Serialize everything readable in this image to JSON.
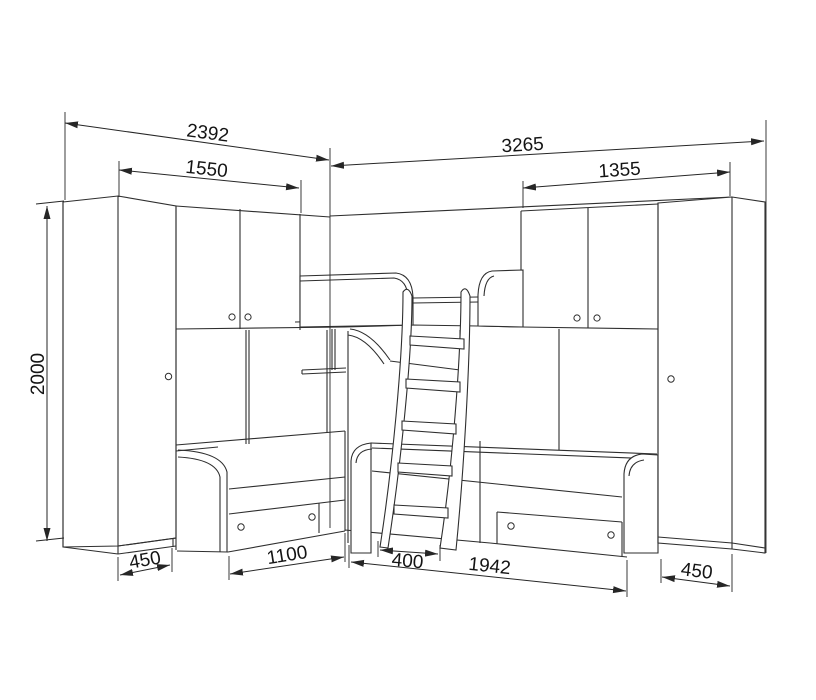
{
  "page": {
    "background": "#ffffff",
    "line_color": "#2e2e2e",
    "text_color": "#141414"
  },
  "diagram": {
    "type": "furniture-dimension-drawing",
    "subject": "corner bunk bed wall unit with two wardrobes, overhead cabinets, drawers and ladder",
    "dimensions": {
      "left_wing_total_width": "2392",
      "left_cabinet_width": "1550",
      "right_wing_total_width": "3265",
      "right_cabinet_width": "1355",
      "unit_height": "2000",
      "left_wardrobe_depth": "450",
      "left_bed_length": "1100",
      "ladder_width": "400",
      "right_bed_length": "1942",
      "right_wardrobe_depth": "450"
    }
  }
}
